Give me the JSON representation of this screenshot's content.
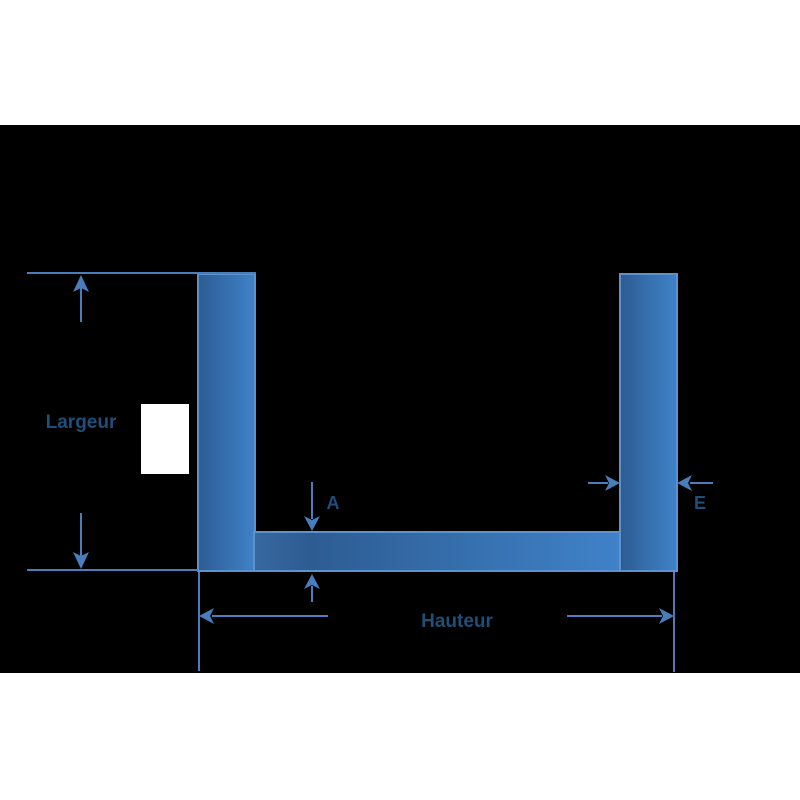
{
  "diagram": {
    "shape": "u-channel-profile-cross-section",
    "labels": {
      "largeur": "Largeur",
      "hauteur": "Hauteur",
      "a": "A",
      "e": "E"
    }
  },
  "colors": {
    "page_background": "#ffffff",
    "canvas_band": "#000000",
    "profile_fill_dark": "#2d5c92",
    "profile_fill_mid": "#36689f",
    "profile_fill_light": "#3f82c9",
    "profile_stroke": "#5d92cc",
    "dimension_line": "#4a7dbc",
    "label_text": "#1f4e79",
    "cutout_box": "#ffffff"
  }
}
